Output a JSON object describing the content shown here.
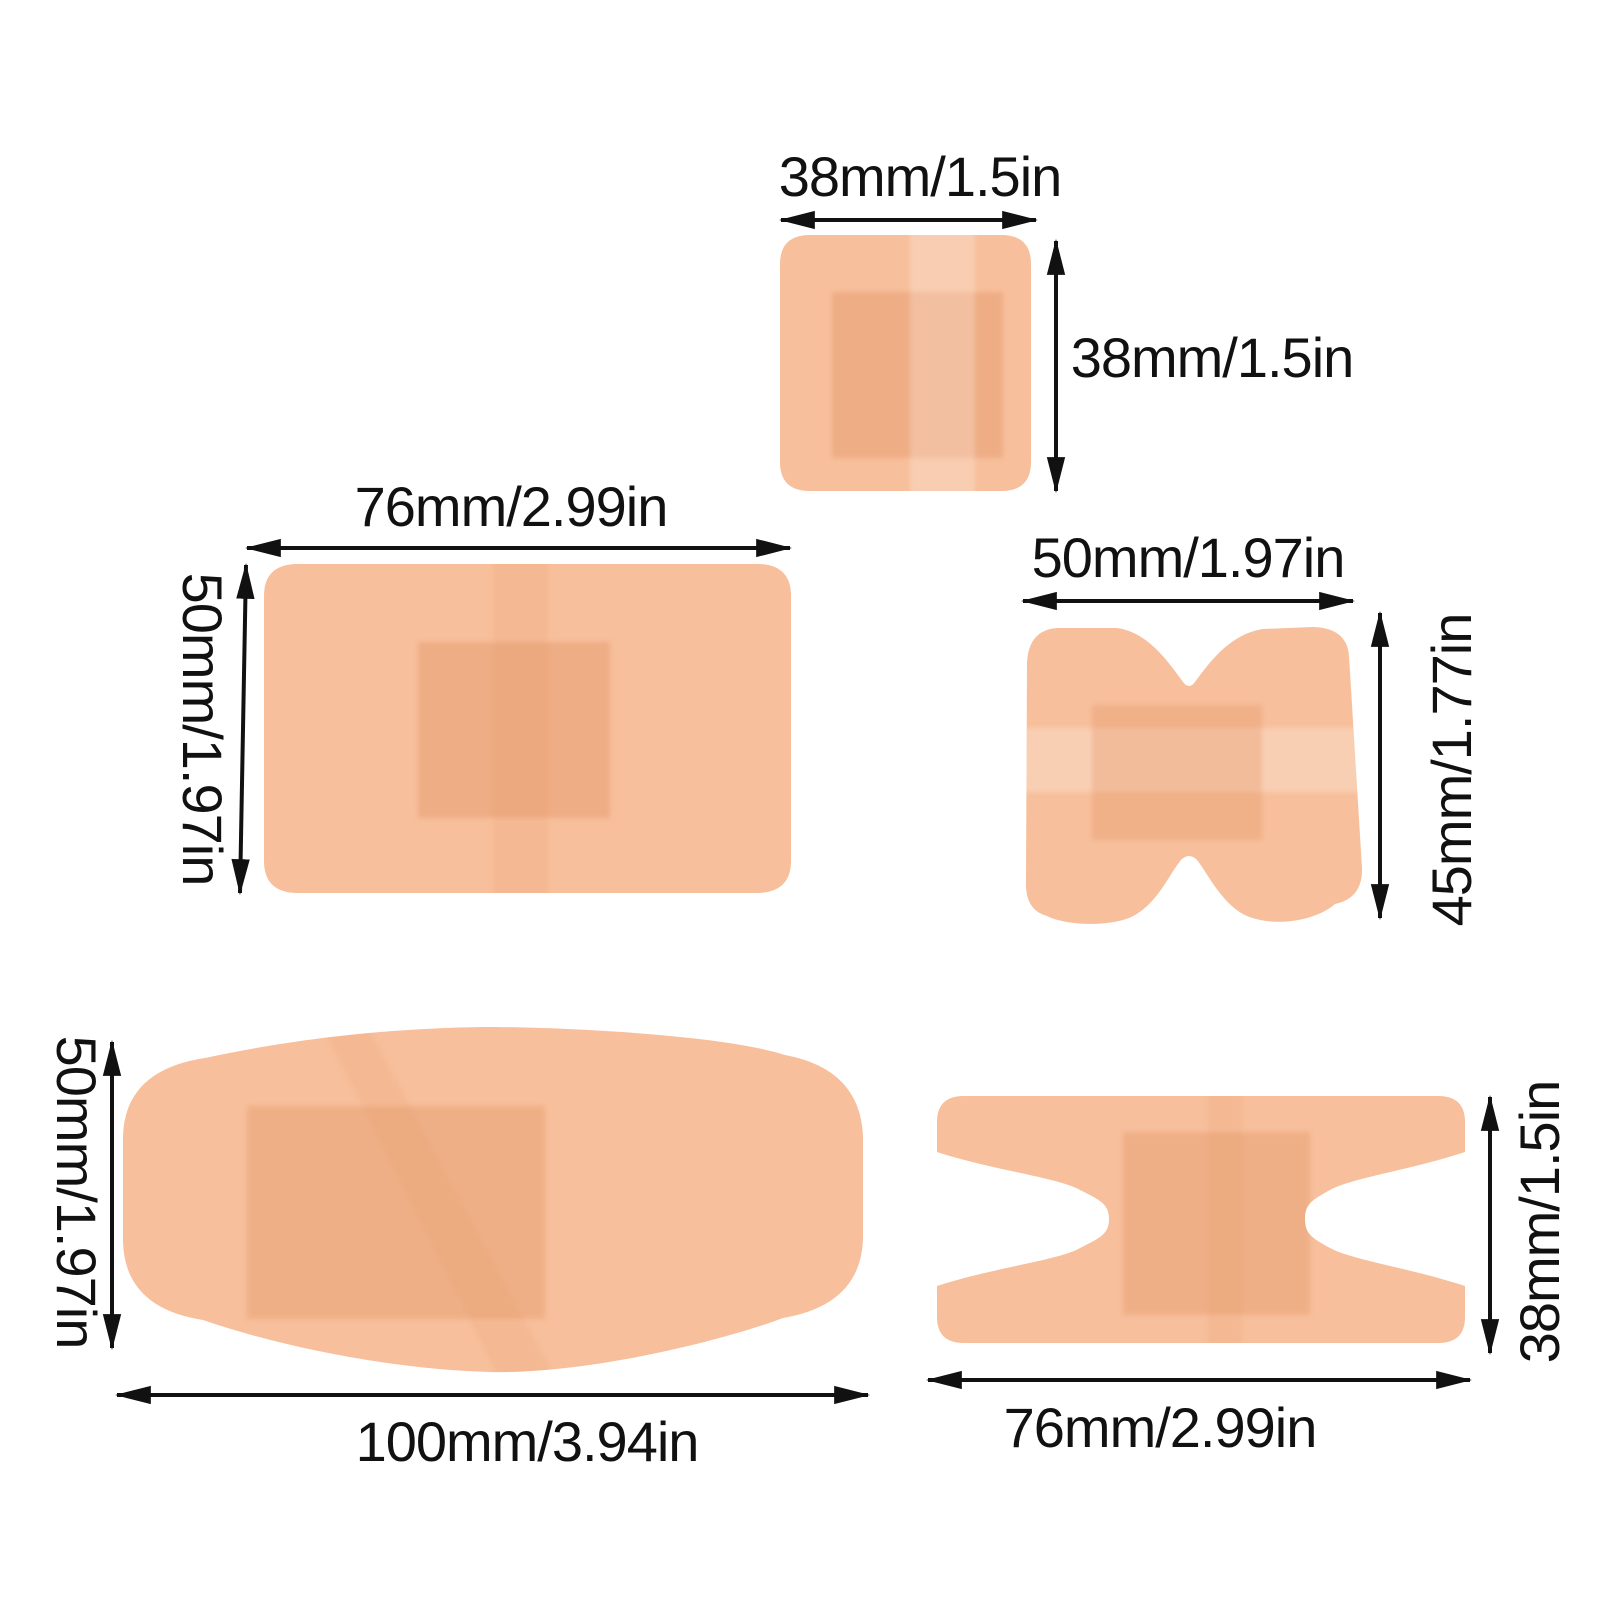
{
  "colors": {
    "background": "#ffffff",
    "bandage_base": "#f7bf9b",
    "bandage_pad": "#dd8a57",
    "bandage_strip_light": "#ffffff",
    "bandage_strip_dark": "#dd8a57",
    "dimension_line": "#111111",
    "label_text": "#111111"
  },
  "bandages": [
    {
      "shape": "square",
      "width_label": "38mm/1.5in",
      "height_label": "38mm/1.5in"
    },
    {
      "shape": "rectangle",
      "width_label": "76mm/2.99in",
      "height_label": "50mm/1.97in"
    },
    {
      "shape": "butterfly",
      "width_label": "50mm/1.97in",
      "height_label": "45mm/1.77in"
    },
    {
      "shape": "large-rectangle",
      "width_label": "100mm/3.94in",
      "height_label": "50mm/1.97in"
    },
    {
      "shape": "knuckle",
      "width_label": "76mm/2.99in",
      "height_label": "38mm/1.5in"
    }
  ]
}
